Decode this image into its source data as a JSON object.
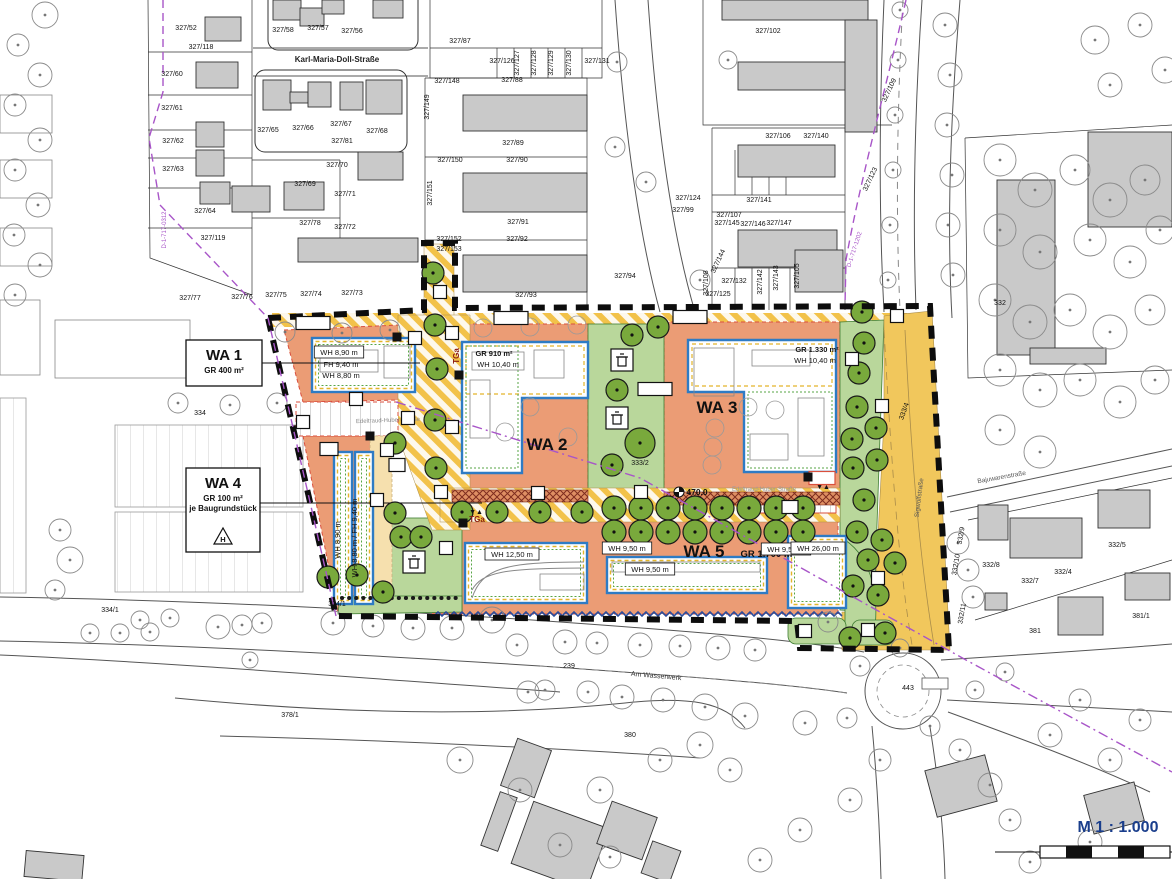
{
  "scale": {
    "label": "M 1 : 1.000",
    "color": "#1a3e8c"
  },
  "streets": [
    {
      "t": "Karl-Maria-Doll-Straße",
      "x": 337,
      "y": 62,
      "r": 0,
      "s": 8,
      "c": "#222",
      "b": true
    },
    {
      "t": "Edeltraud-Huber-Straße",
      "x": 388,
      "y": 422,
      "r": -2,
      "s": 6,
      "c": "#8a8a8a",
      "b": false
    },
    {
      "t": "Edeltraud-Huber-Straße",
      "x": 764,
      "y": 491,
      "r": 0,
      "s": 6,
      "c": "#9a9a9a",
      "b": false
    },
    {
      "t": "Sigwolfstraße",
      "x": 921,
      "y": 498,
      "r": -83,
      "s": 6.5,
      "c": "#555",
      "b": false
    },
    {
      "t": "Bajuwarenstraße",
      "x": 1002,
      "y": 479,
      "r": -10,
      "s": 6.5,
      "c": "#555",
      "b": false
    },
    {
      "t": "Am Wasserwerk",
      "x": 656,
      "y": 678,
      "r": 5,
      "s": 7,
      "c": "#333",
      "b": false
    }
  ],
  "parcels": [
    [
      "327/52",
      186,
      30
    ],
    [
      "327/118",
      201,
      49
    ],
    [
      "327/58",
      283,
      32
    ],
    [
      "327/57",
      318,
      30
    ],
    [
      "327/56",
      352,
      33
    ],
    [
      "327/60",
      172,
      76
    ],
    [
      "327/61",
      172,
      110
    ],
    [
      "327/62",
      173,
      143
    ],
    [
      "327/63",
      173,
      171
    ],
    [
      "327/64",
      205,
      213
    ],
    [
      "327/119",
      213,
      240
    ],
    [
      "327/65",
      268,
      132
    ],
    [
      "327/66",
      303,
      130
    ],
    [
      "327/67",
      341,
      126
    ],
    [
      "327/81",
      342,
      143
    ],
    [
      "327/68",
      377,
      133
    ],
    [
      "327/70",
      337,
      167
    ],
    [
      "327/69",
      305,
      186
    ],
    [
      "327/71",
      345,
      196
    ],
    [
      "327/78",
      310,
      225
    ],
    [
      "327/72",
      345,
      229
    ],
    [
      "327/77",
      190,
      300
    ],
    [
      "327/76",
      242,
      299
    ],
    [
      "327/75",
      276,
      297
    ],
    [
      "327/74",
      311,
      296
    ],
    [
      "327/73",
      352,
      295
    ],
    [
      "327/87",
      460,
      43
    ],
    [
      "327/126",
      502,
      63
    ],
    [
      "327/127",
      519,
      63,
      -90
    ],
    [
      "327/128",
      536,
      63,
      -90
    ],
    [
      "327/129",
      553,
      63,
      -90
    ],
    [
      "327/130",
      571,
      63,
      -90
    ],
    [
      "327/131",
      597,
      63
    ],
    [
      "327/148",
      447,
      83
    ],
    [
      "327/88",
      512,
      82
    ],
    [
      "327/149",
      429,
      107,
      -90
    ],
    [
      "327/89",
      513,
      145
    ],
    [
      "327/150",
      450,
      162
    ],
    [
      "327/90",
      517,
      162
    ],
    [
      "327/151",
      432,
      193,
      -90
    ],
    [
      "327/91",
      518,
      224
    ],
    [
      "327/152",
      449,
      241
    ],
    [
      "327/92",
      517,
      241
    ],
    [
      "327/153",
      449,
      251
    ],
    [
      "327/93",
      526,
      297
    ],
    [
      "327/94",
      625,
      278
    ],
    [
      "327/102",
      768,
      33
    ],
    [
      "327/106",
      778,
      138
    ],
    [
      "327/140",
      816,
      138
    ],
    [
      "327/109",
      891,
      91,
      -65
    ],
    [
      "327/123",
      872,
      180,
      -65
    ],
    [
      "327/124",
      688,
      200
    ],
    [
      "327/99",
      683,
      212
    ],
    [
      "327/141",
      759,
      202
    ],
    [
      "327/107",
      729,
      217
    ],
    [
      "327/145",
      727,
      225
    ],
    [
      "327/146",
      753,
      226
    ],
    [
      "327/147",
      779,
      225
    ],
    [
      "327/144",
      720,
      262,
      -65
    ],
    [
      "327/108",
      708,
      283,
      -90
    ],
    [
      "327/132",
      734,
      283
    ],
    [
      "327/142",
      762,
      282,
      -90
    ],
    [
      "327/143",
      778,
      278,
      -90
    ],
    [
      "327/105",
      799,
      276,
      -90
    ],
    [
      "327/125",
      718,
      296
    ],
    [
      "332",
      1000,
      305
    ],
    [
      "332/5",
      1117,
      547
    ],
    [
      "332/8",
      991,
      567
    ],
    [
      "332/7",
      1030,
      583
    ],
    [
      "332/4",
      1063,
      574
    ],
    [
      "332/9",
      963,
      536,
      -80
    ],
    [
      "332/10",
      958,
      565,
      -80
    ],
    [
      "332/11",
      964,
      614,
      -80
    ],
    [
      "381/1",
      1141,
      618
    ],
    [
      "381",
      1035,
      633
    ],
    [
      "334",
      200,
      415
    ],
    [
      "334/1",
      110,
      612
    ],
    [
      "334/1",
      337,
      606
    ],
    [
      "333/2",
      640,
      465
    ],
    [
      "333/4",
      906,
      412,
      -70
    ],
    [
      "239",
      569,
      668
    ],
    [
      "380",
      630,
      737
    ],
    [
      "378/1",
      290,
      717
    ],
    [
      "443",
      908,
      690
    ]
  ],
  "zone_boxes": {
    "wa1": {
      "title": "WA 1",
      "line2": "GR 400 m²"
    },
    "wa4": {
      "title": "WA 4",
      "line2": "GR 100 m²",
      "line3": "je Baugrundstück",
      "symbol": "H"
    }
  },
  "zone_texts": [
    {
      "t": "WA 2",
      "x": 547,
      "y": 450,
      "s": 17
    },
    {
      "t": "WA 3",
      "x": 717,
      "y": 413,
      "s": 17
    },
    {
      "t": "WA 5",
      "x": 704,
      "y": 557,
      "s": 17
    },
    {
      "t": "GR 1.700 m²",
      "x": 768,
      "y": 557,
      "s": 9.5
    }
  ],
  "annotations": [
    {
      "t": "WH 8,90 m",
      "x": 339,
      "y": 355,
      "b": false,
      "box": true
    },
    {
      "t": "FH 9,40 m",
      "x": 341,
      "y": 367,
      "b": false,
      "box": false
    },
    {
      "t": "WH 8,80 m",
      "x": 341,
      "y": 378,
      "b": false,
      "box": false
    },
    {
      "t": "GR 910 m²",
      "x": 494,
      "y": 356,
      "b": true,
      "box": false
    },
    {
      "t": "WH 10,40 m",
      "x": 498,
      "y": 367,
      "b": false,
      "box": false
    },
    {
      "t": "GR 1.330 m²",
      "x": 817,
      "y": 352,
      "b": true,
      "box": false
    },
    {
      "t": "WH 10,40 m",
      "x": 815,
      "y": 363,
      "b": false,
      "box": false
    },
    {
      "t": "WH 12,50 m",
      "x": 512,
      "y": 557,
      "b": false,
      "box": true
    },
    {
      "t": "WH 9,50 m",
      "x": 627,
      "y": 551,
      "b": false,
      "box": true
    },
    {
      "t": "WH 9,50 m",
      "x": 650,
      "y": 572,
      "b": false,
      "box": true
    },
    {
      "t": "WH 9,50 m",
      "x": 786,
      "y": 552,
      "b": false,
      "box": true
    },
    {
      "t": "WH 26,00 m",
      "x": 818,
      "y": 551,
      "b": false,
      "box": true
    },
    {
      "t": "WH 8,90 m",
      "x": 340,
      "y": 540,
      "r": -90,
      "b": false,
      "box": false
    },
    {
      "t": "WH 8,80 m / FH 9,40 m",
      "x": 357,
      "y": 538,
      "r": -90,
      "b": false,
      "box": false
    }
  ],
  "benchmark": {
    "t": "470.0",
    "x": 693,
    "y": 495
  },
  "monument_labels": [
    {
      "t": "D-1-717-1202",
      "x": 856,
      "y": 250,
      "r": -72
    },
    {
      "t": "D-1-717-0312",
      "x": 166,
      "y": 230,
      "r": -90
    }
  ],
  "markers": {
    "labels": {
      "g": "G",
      "f": "F",
      "v": "V",
      "st": "St",
      "ca": "Ca",
      "m": "M",
      "tga": "TGa",
      "fr": "F + R",
      "arrows": "▼▲"
    },
    "g": [
      [
        440,
        292
      ],
      [
        415,
        338
      ],
      [
        356,
        399
      ],
      [
        303,
        422
      ],
      [
        387,
        450
      ],
      [
        441,
        492
      ],
      [
        538,
        493
      ],
      [
        897,
        316
      ],
      [
        852,
        359
      ],
      [
        882,
        406
      ],
      [
        878,
        578
      ],
      [
        805,
        631
      ],
      [
        868,
        630
      ]
    ],
    "f": [
      [
        452,
        333
      ],
      [
        452,
        427
      ],
      [
        377,
        500
      ],
      [
        446,
        548
      ]
    ],
    "v": [
      [
        408,
        418
      ],
      [
        641,
        492
      ]
    ],
    "st": [
      [
        397,
        465
      ],
      [
        790,
        507
      ]
    ],
    "ca": [
      [
        329,
        449
      ]
    ],
    "m": [
      [
        397,
        337
      ],
      [
        459,
        375
      ],
      [
        370,
        436
      ],
      [
        463,
        523
      ],
      [
        808,
        477
      ]
    ],
    "fr": [
      [
        313,
        323
      ],
      [
        511,
        318
      ],
      [
        690,
        317
      ],
      [
        655,
        389
      ]
    ],
    "tga_box": [
      [
        822,
        478
      ]
    ],
    "tga_text": [
      [
        477,
        522,
        0
      ],
      [
        459,
        356,
        -90
      ]
    ],
    "arrows": [
      [
        476,
        514
      ],
      [
        823,
        489
      ]
    ],
    "bins": [
      [
        622,
        360
      ],
      [
        617,
        418
      ],
      [
        414,
        562
      ]
    ]
  },
  "colors": {
    "zone_orange": "#EB9C75",
    "green_area": "#B9D79B",
    "tree_green": "#79A93C",
    "road_yellow": "#F1C75C",
    "hatch_yellow": "#F2C24A",
    "building_blue": "#2E7BC4",
    "dash_yellow": "#E3B52B",
    "zig_green": "#57A546",
    "red_dash": "#D94F3D",
    "cross_brown": "#7E2D1F",
    "wall_blue": "#2B4C9B",
    "monument_purple": "#A855C8"
  }
}
